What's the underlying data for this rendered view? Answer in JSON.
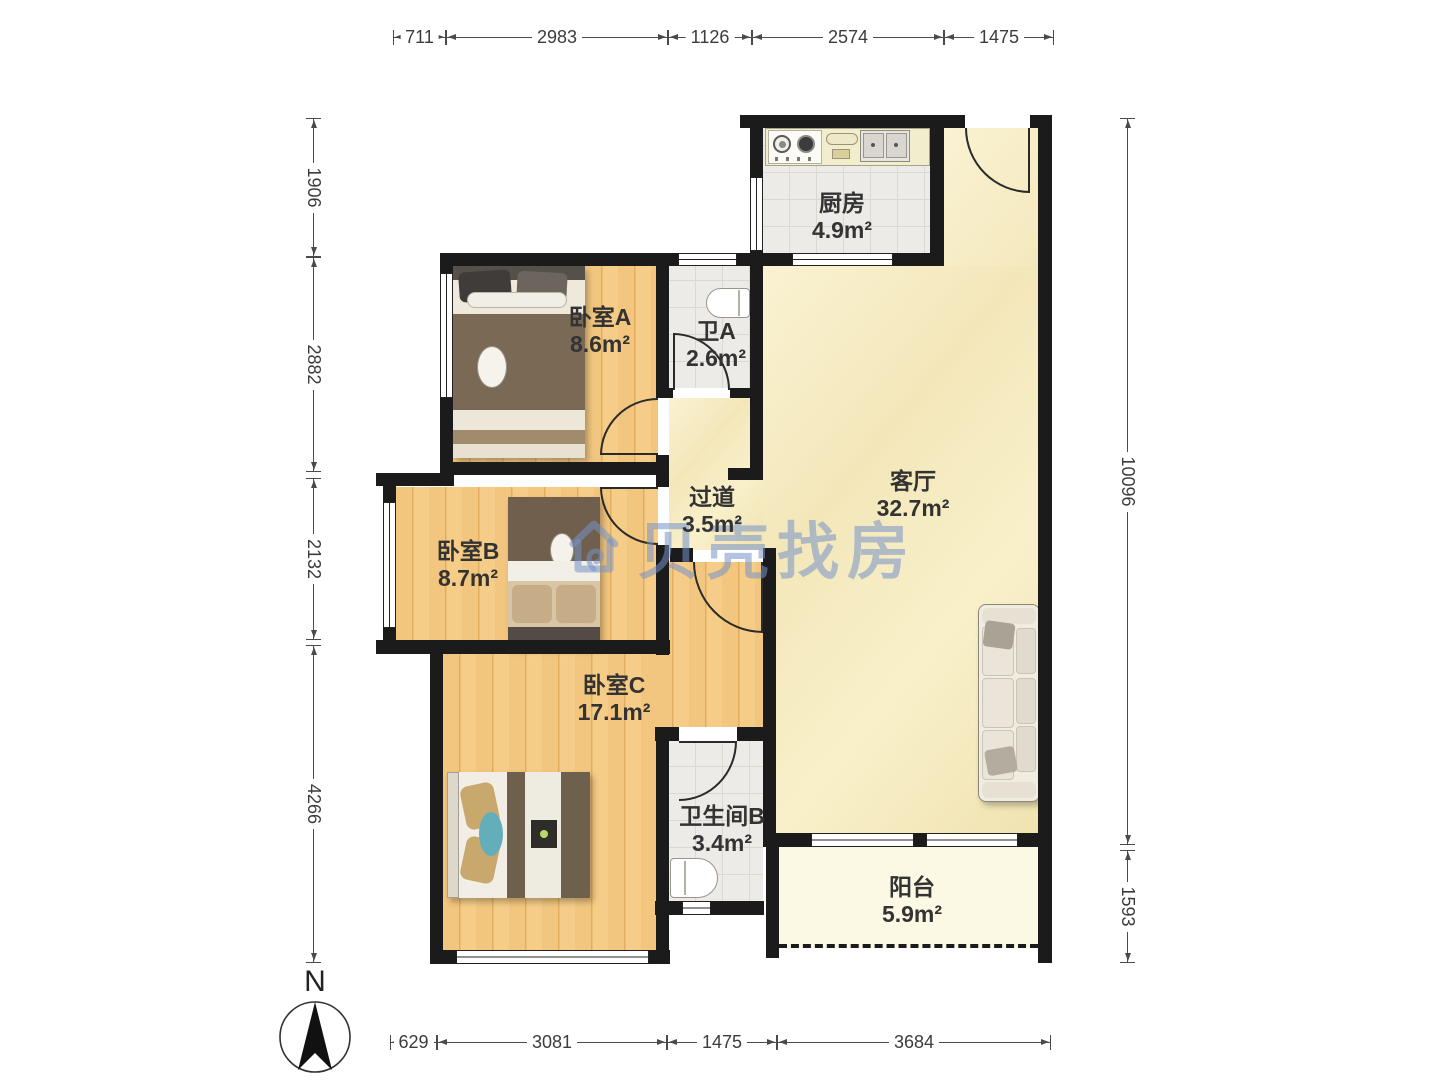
{
  "watermark": {
    "text": "贝壳找房"
  },
  "compass": {
    "label": "N"
  },
  "rooms": [
    {
      "id": "kitchen",
      "name": "厨房",
      "area": "4.9m²",
      "x": 842,
      "y": 190
    },
    {
      "id": "bedroom-a",
      "name": "卧室A",
      "area": "8.6m²",
      "x": 600,
      "y": 304
    },
    {
      "id": "bathroom-a",
      "name": "卫A",
      "area": "2.6m²",
      "x": 716,
      "y": 318
    },
    {
      "id": "hallway",
      "name": "过道",
      "area": "3.5m²",
      "x": 712,
      "y": 484
    },
    {
      "id": "living-room",
      "name": "客厅",
      "area": "32.7m²",
      "x": 913,
      "y": 468
    },
    {
      "id": "bedroom-b",
      "name": "卧室B",
      "area": "8.7m²",
      "x": 468,
      "y": 538
    },
    {
      "id": "bedroom-c",
      "name": "卧室C",
      "area": "17.1m²",
      "x": 614,
      "y": 672
    },
    {
      "id": "bathroom-b",
      "name": "卫生间B",
      "area": "3.4m²",
      "x": 722,
      "y": 803
    },
    {
      "id": "balcony",
      "name": "阳台",
      "area": "5.9m²",
      "x": 912,
      "y": 874
    }
  ],
  "dimensions": {
    "top": {
      "y": 27,
      "segments": [
        {
          "label": "711",
          "from": 393,
          "to": 446
        },
        {
          "label": "2983",
          "from": 446,
          "to": 668
        },
        {
          "label": "1126",
          "from": 668,
          "to": 752
        },
        {
          "label": "2574",
          "from": 752,
          "to": 944
        },
        {
          "label": "1475",
          "from": 944,
          "to": 1054
        }
      ]
    },
    "bottom": {
      "y": 1032,
      "segments": [
        {
          "label": "629",
          "from": 390,
          "to": 437
        },
        {
          "label": "3081",
          "from": 437,
          "to": 667
        },
        {
          "label": "1475",
          "from": 667,
          "to": 777
        },
        {
          "label": "3684",
          "from": 777,
          "to": 1051
        }
      ]
    },
    "left": {
      "x": 324,
      "segments": [
        {
          "label": "1906",
          "from": 118,
          "to": 257
        },
        {
          "label": "2882",
          "from": 257,
          "to": 472
        },
        {
          "label": "2132",
          "from": 478,
          "to": 640
        },
        {
          "label": "4266",
          "from": 645,
          "to": 963
        }
      ]
    },
    "right": {
      "x": 1138,
      "segments": [
        {
          "label": "10096",
          "from": 118,
          "to": 845
        },
        {
          "label": "1593",
          "from": 850,
          "to": 963
        }
      ]
    }
  },
  "colors": {
    "wall": "#1b1b1b",
    "wood_floor": "#f1c47c",
    "living_floor": "#f7edc6",
    "tile_floor": "#edebe8",
    "balcony_floor": "#fbf8e3",
    "watermark": "#7492c8",
    "dimension_text": "#3c3c3c",
    "label_text": "#333333"
  }
}
